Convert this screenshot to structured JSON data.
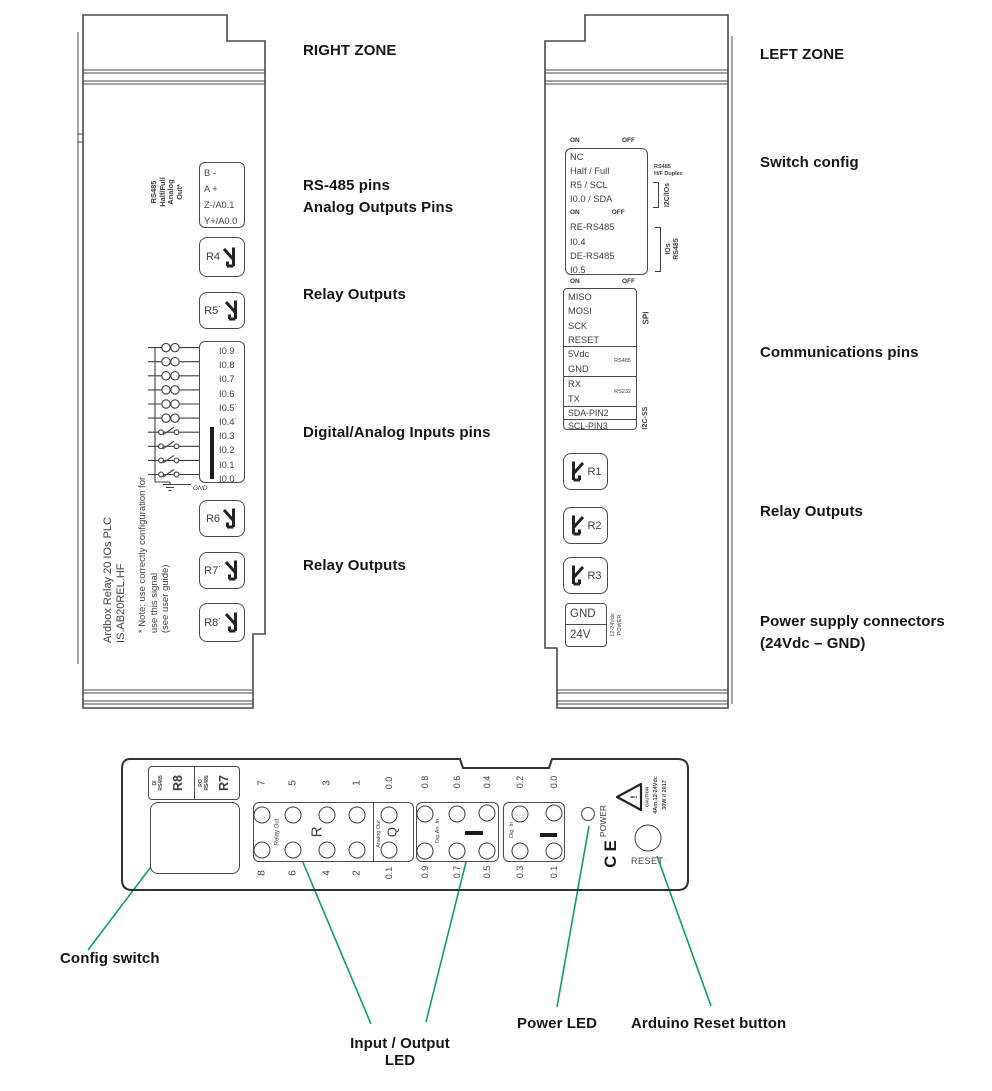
{
  "colors": {
    "line": "#4a4a4a",
    "device_text": "#3f3f3f",
    "annotation_text": "#161616",
    "callout_green": "#0fa058"
  },
  "annotations": {
    "right_zone_title": "RIGHT ZONE",
    "rs485_pins": "RS-485 pins",
    "analog_outputs": "Analog Outputs Pins",
    "relay_outputs_1": "Relay Outputs",
    "digital_inputs": "Digital/Analog Inputs pins",
    "relay_outputs_2": "Relay Outputs",
    "left_zone_title": "LEFT ZONE",
    "switch_config": "Switch config",
    "communications": "Communications pins",
    "relay_outputs_3": "Relay Outputs",
    "power_supply_1": "Power supply connectors",
    "power_supply_2": "(24Vdc – GND)",
    "config_switch": "Config switch",
    "io_led_1": "Input / Output",
    "io_led_2": "LED",
    "power_led": "Power LED",
    "reset_button": "Arduino Reset button"
  },
  "right_device": {
    "header_rotated": "RS485\nHalf/Full\nAnalog\nOut*",
    "terminal_pins": [
      "B -",
      "A +",
      "Z-/A0.1",
      "Y+/A0.0"
    ],
    "relay_r4": "R4",
    "relay_r5": "R5˙",
    "input_pins": [
      "I0.9",
      "I0.8",
      "I0.7",
      "I0.6",
      "I0.5˙",
      "I0.4˙",
      "I0.3",
      "I0.2",
      "I0.1",
      "I0.0˙"
    ],
    "gnd": "GND",
    "product_text": "Ardbox Relay 20 IOs PLC\nIS.AB20REL.HF",
    "note_text": "* Note: use correctly configuration for\nuse this signal\n(see user guide)",
    "relay_r6": "R6",
    "relay_r7": "R7˙",
    "relay_r8": "R8˙"
  },
  "left_device": {
    "on": "ON",
    "off": "OFF",
    "switch_rows_top": [
      "NC",
      "Half / Full",
      "R5 / SCL",
      "I0.0 / SDA"
    ],
    "switch_rows_bottom": [
      "RE-RS485",
      "I0.4",
      "DE-RS485",
      "I0.5"
    ],
    "tag_rs485_hf": "RS485\nH/F Duplex",
    "tag_i2c_ios": "I2C/IOs",
    "tag_rs485_ios": "IOs\nRS485",
    "spi_rows": [
      "MISO",
      "MOSI",
      "SCK",
      "RESET"
    ],
    "tag_spi": "SPI",
    "power_rows": [
      "5Vdc",
      "GND"
    ],
    "tag_rs485": "RS485",
    "serial_rows": [
      "RX",
      "TX"
    ],
    "tag_rs232": "RS232",
    "i2c_rows": [
      "SDA-PIN2",
      "SCL-PIN3"
    ],
    "tag_i2c_ss": "I2C-SS",
    "relay_r1": "R1",
    "relay_r2": "R2",
    "relay_r3": "R3",
    "power_gnd": "GND",
    "power_24v": "24V",
    "tag_power": "12-24Vdc\nPOWER"
  },
  "bottom_view": {
    "di_cell": {
      "small": "DI\nRS485",
      "big": "R8"
    },
    "ro_cell": {
      "small": "RO\nRS485",
      "big": "R7"
    },
    "relay_out": {
      "label": "Relay Out",
      "big": "R",
      "top_nums": [
        "7",
        "5",
        "3",
        "1"
      ],
      "bottom_nums": [
        "8",
        "6",
        "4",
        "2"
      ]
    },
    "analog_out": {
      "label": "Analog Out",
      "big": "Q",
      "top": "0.0",
      "bottom": "0.1"
    },
    "digan_in": {
      "label": "Dig.An. In",
      "top_nums": [
        "0.8",
        "0.6",
        "0.4"
      ],
      "bottom_nums": [
        "0.9",
        "0.7",
        "0.5"
      ]
    },
    "dig_in": {
      "label": "Dig. In",
      "top_nums": [
        "0.2",
        "0.0"
      ],
      "bottom_nums": [
        "0.3",
        "0.1"
      ]
    },
    "power": "POWER",
    "ce": "CE",
    "caution": {
      "word": "CAUTION",
      "mark": "!",
      "line1": "4Am,12-24Vdc",
      "line2": "30W // 2017"
    },
    "reset": "RESET"
  }
}
